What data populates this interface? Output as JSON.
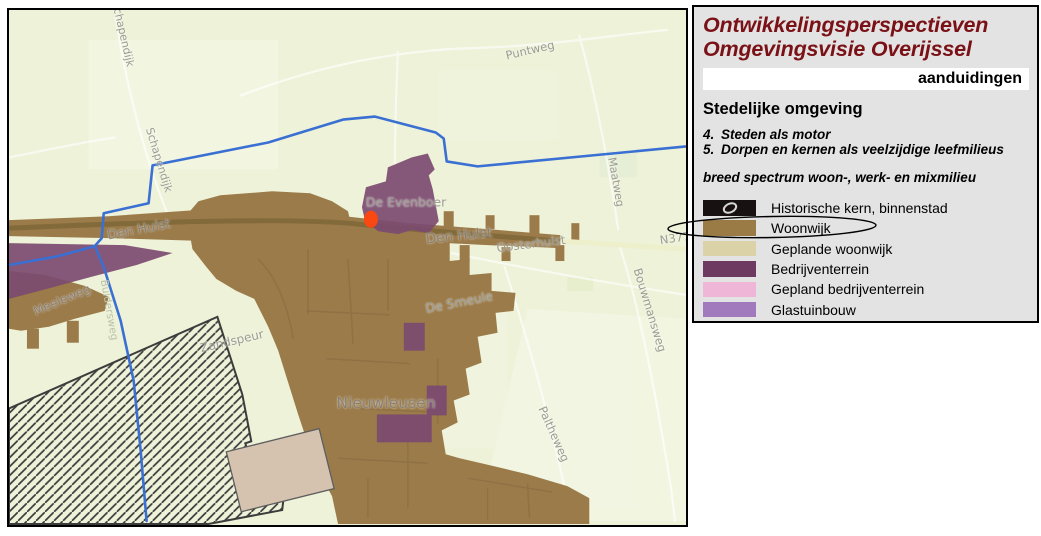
{
  "legend_panel": {
    "title_line1": "Ontwikkelingsperspectieven",
    "title_line2": "Omgevingsvisie Overijssel",
    "title_color": "#7a1116",
    "section_bar_label": "aanduidingen",
    "heading": "Stedelijke omgeving",
    "numbered_items": [
      {
        "num": "4.",
        "label": "Steden als motor"
      },
      {
        "num": "5.",
        "label": "Dorpen en kernen als veelzijdige leefmilieus"
      }
    ],
    "subheading": "breed spectrum woon-, werk- en mixmilieu",
    "legend_items": [
      {
        "label": "Historische kern, binnenstad",
        "color": "#171112",
        "icon": "scribble-ellipse"
      },
      {
        "label": "Woonwijk",
        "color": "#9a7b45",
        "annotated": "circled"
      },
      {
        "label": "Geplande woonwijk",
        "color": "#dcd2a8"
      },
      {
        "label": "Bedrijventerrein",
        "color": "#6f3a62"
      },
      {
        "label": "Gepland bedrijventerrein",
        "color": "#f0b6d8"
      },
      {
        "label": "Glastuinbouw",
        "color": "#a179bd"
      }
    ]
  },
  "map": {
    "colors": {
      "background": "#edf2d8",
      "field_light": "#f5f8e7",
      "field_dark": "#e3edc9",
      "pond": "#e2eed6",
      "road": "#ffffff",
      "highway_east": "#edf0cb",
      "woonwijk": "#9b7b4a",
      "woonwijk_street": "#876940",
      "corridor_road": "#7f6839",
      "geplande_woonwijk": "#d5c3b0",
      "bedrijventerrein": "#7c4a70",
      "canal": "#3a6fd3",
      "hatch_line": "#3b3b3b",
      "marker": "#fb4712"
    },
    "marker": {
      "color": "#fb4712",
      "shape": "ellipse"
    },
    "labels": [
      {
        "text": "Schapendijk"
      },
      {
        "text": "Schapendijk"
      },
      {
        "text": "Puntweg"
      },
      {
        "text": "Maatweg"
      },
      {
        "text": "N377"
      },
      {
        "text": "De Evenboer"
      },
      {
        "text": "Den Hulst"
      },
      {
        "text": "Den Hulst"
      },
      {
        "text": "Oosterhulst"
      },
      {
        "text": "De Smeule"
      },
      {
        "text": "Nieuwleusen"
      },
      {
        "text": "Meeleweg"
      },
      {
        "text": "Zandspeur"
      },
      {
        "text": "Buldersweg"
      },
      {
        "text": "Paltheweg"
      },
      {
        "text": "Bouwmansweg"
      }
    ]
  }
}
